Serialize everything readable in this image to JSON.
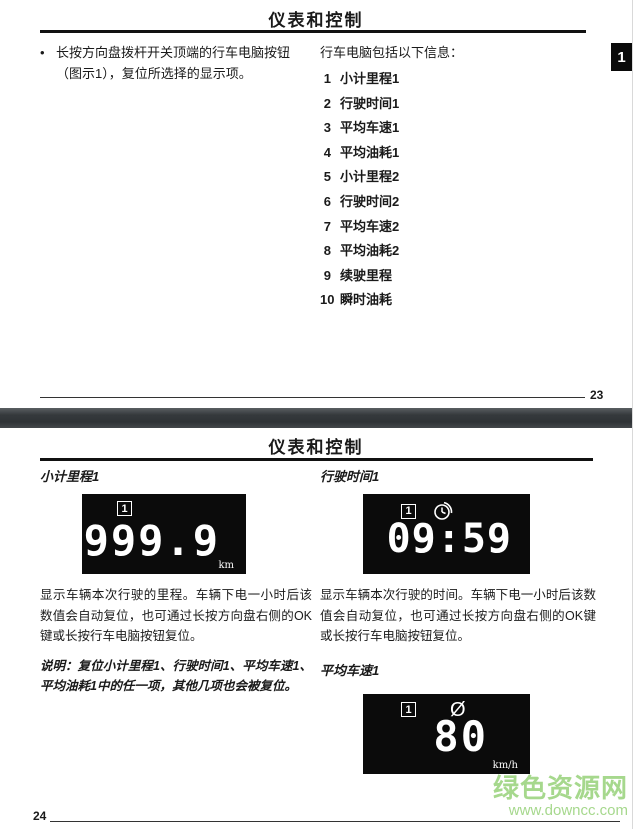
{
  "page1": {
    "title": "仪表和控制",
    "bullet_marker": "•",
    "bullet_text": "长按方向盘拨杆开关顶端的行车电脑按钮（图示1），复位所选择的显示项。",
    "list_header": "行车电脑包括以下信息：",
    "items": [
      {
        "num": "1",
        "label": "小计里程1"
      },
      {
        "num": "2",
        "label": "行驶时间1"
      },
      {
        "num": "3",
        "label": "平均车速1"
      },
      {
        "num": "4",
        "label": "平均油耗1"
      },
      {
        "num": "5",
        "label": "小计里程2"
      },
      {
        "num": "6",
        "label": "行驶时间2"
      },
      {
        "num": "7",
        "label": "平均车速2"
      },
      {
        "num": "8",
        "label": "平均油耗2"
      },
      {
        "num": "9",
        "label": "续驶里程"
      },
      {
        "num": "10",
        "label": "瞬时油耗"
      }
    ],
    "tab_label": "1",
    "page_number": "23"
  },
  "page2": {
    "title": "仪表和控制",
    "trip": {
      "heading": "小计里程1",
      "lcd": {
        "indicator": "1",
        "value": "999.9",
        "unit": "km"
      },
      "body": "显示车辆本次行驶的里程。车辆下电一小时后该数值会自动复位，也可通过长按方向盘右侧的OK键或长按行车电脑按钮复位。",
      "note": "说明：复位小计里程1、行驶时间1、平均车速1、平均油耗1中的任一项，其他几项也会被复位。"
    },
    "time": {
      "heading": "行驶时间1",
      "lcd": {
        "indicator": "1",
        "value": "09:59"
      },
      "body": "显示车辆本次行驶的时间。车辆下电一小时后该数值会自动复位，也可通过长按方向盘右侧的OK键或长按行车电脑按钮复位。"
    },
    "speed": {
      "heading": "平均车速1",
      "lcd": {
        "indicator": "1",
        "symbol": "Ø",
        "value": "80",
        "unit": "km/h"
      }
    },
    "page_number": "24"
  },
  "watermark": {
    "title": "绿色资源网",
    "url": "www.downcc.com"
  },
  "colors": {
    "lcd_background": "#0b0b0b",
    "lcd_foreground": "#ffffff",
    "watermark_green": "#a6d88d",
    "divider_gray": "#35393c",
    "text": "#1a1a1a"
  }
}
